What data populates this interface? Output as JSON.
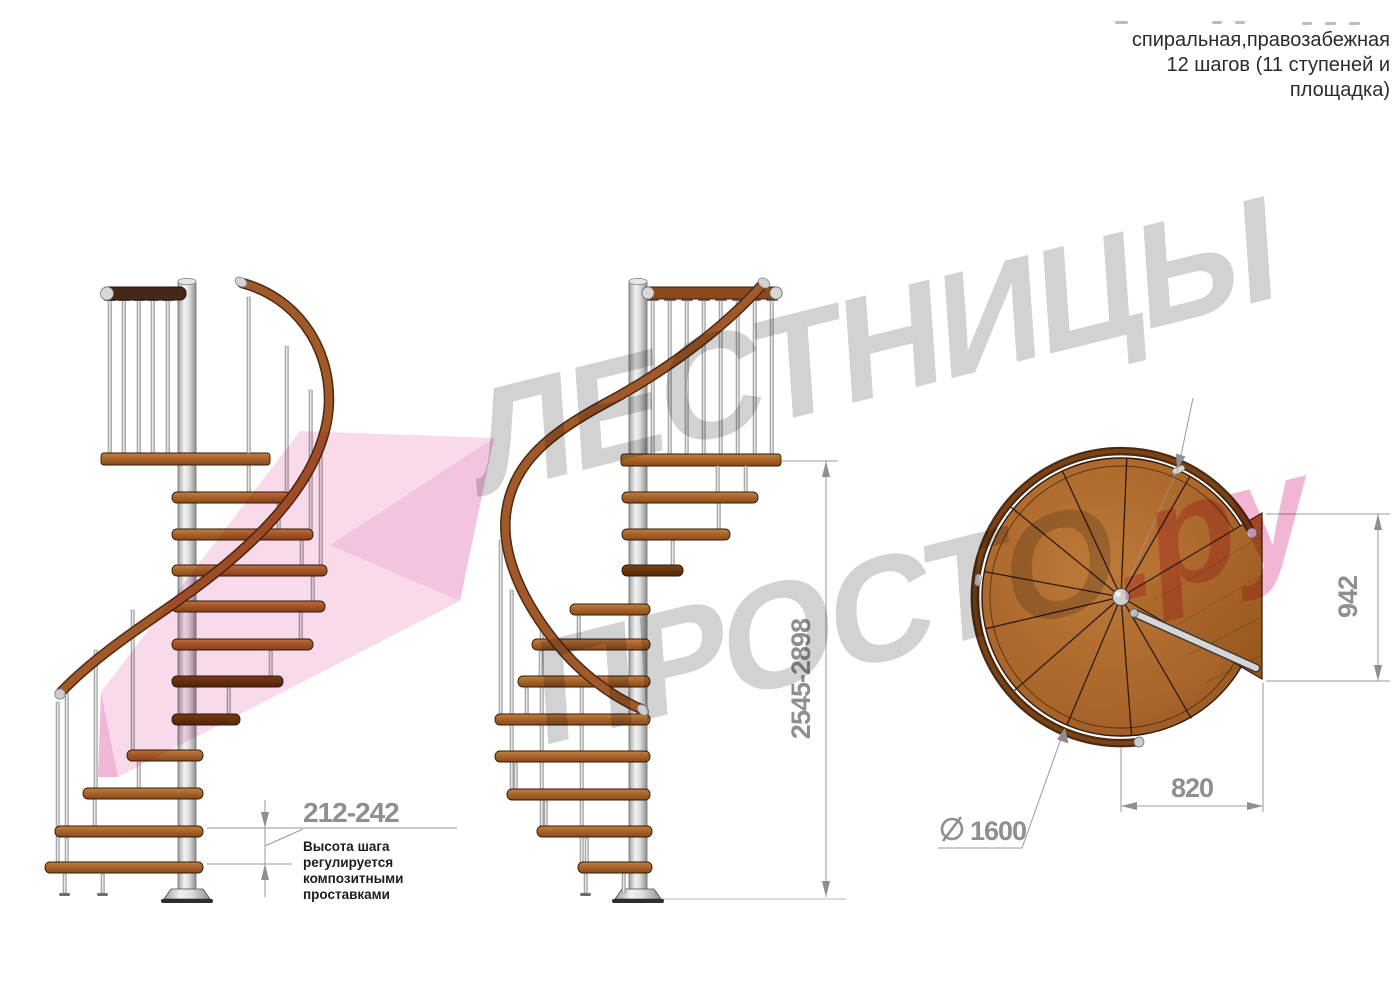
{
  "header": {
    "line1": "спиральная,правозабежная",
    "line2": "12 шагов (11 ступеней и",
    "line3": "площадка)"
  },
  "annotations": {
    "step_height": {
      "value": "212-242",
      "note": [
        "Высота шага",
        "регулируется",
        "композитными",
        "проставками"
      ]
    },
    "total_height": {
      "value": "2545-2898"
    },
    "platform_depth": {
      "value": "942"
    },
    "platform_width": {
      "value": "820"
    },
    "diameter": {
      "value": "1600",
      "symbol": "⌀"
    }
  },
  "watermark": {
    "word1": "ЛЕСТНИЦЫ",
    "word2": "ПРОСТО",
    "word2_suffix": ".ру"
  },
  "colors": {
    "wood": "#a9652a",
    "wood_dark": "#6e3a14",
    "handrail": "#a2592a",
    "metal": "#d9d9d9",
    "dimension_text": "#8f8f8f",
    "note_text": "#1d1d1d",
    "header_text": "#2b2b2b",
    "watermark_gray": "#969696",
    "watermark_pink": "#e77ab2"
  }
}
